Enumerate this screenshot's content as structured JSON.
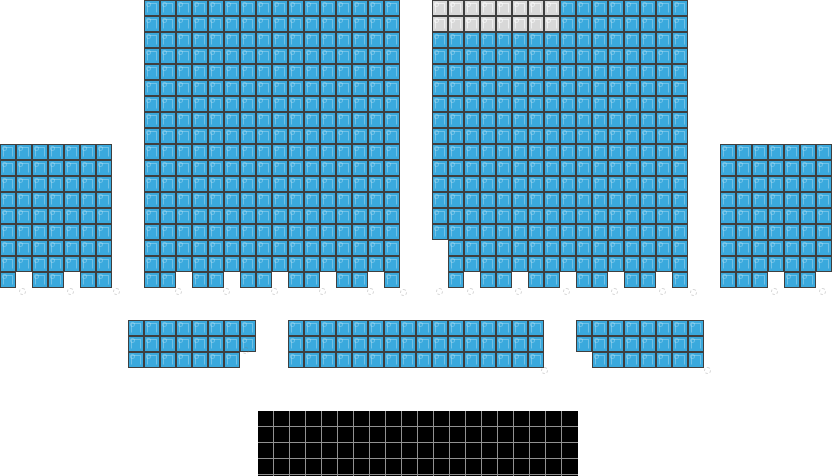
{
  "canvas": {
    "width": 832,
    "height": 476,
    "background": "#ffffff"
  },
  "seat": {
    "size": 16
  },
  "colors": {
    "seat_border": "#3f3f3f",
    "available_fill": "#3aa9dd",
    "available_glyph": "rgba(255,255,255,0.28)",
    "unavailable_fill": "#d8d8d8",
    "unavailable_glyph": "rgba(255,255,255,0.60)",
    "stage_fill": "#000000",
    "stage_line": "#919191",
    "ghost": "rgba(120,120,120,0.30)"
  },
  "sections": [
    {
      "id": "left-wing-section",
      "x": 0,
      "y": 144,
      "cols": 7,
      "rows": 9,
      "default": "available",
      "missing": [
        [
          9,
          2
        ],
        [
          9,
          5
        ]
      ],
      "overrides": []
    },
    {
      "id": "center-left-section",
      "x": 144,
      "y": 0,
      "cols": 16,
      "rows": 18,
      "default": "available",
      "missing": [
        [
          18,
          3
        ],
        [
          18,
          6
        ],
        [
          18,
          9
        ],
        [
          18,
          12
        ],
        [
          18,
          15
        ]
      ],
      "overrides": []
    },
    {
      "id": "center-right-section",
      "x": 432,
      "y": 0,
      "cols": 16,
      "rows": 18,
      "default": "available",
      "missing": [
        [
          16,
          1
        ],
        [
          17,
          1
        ],
        [
          18,
          1
        ],
        [
          18,
          3
        ],
        [
          18,
          6
        ],
        [
          18,
          9
        ],
        [
          18,
          12
        ],
        [
          18,
          15
        ]
      ],
      "overrides": [
        {
          "row_start": 1,
          "row_end": 2,
          "col_start": 1,
          "col_end": 8,
          "state": "unavailable"
        }
      ]
    },
    {
      "id": "right-wing-section",
      "x": 720,
      "y": 144,
      "cols": 7,
      "rows": 9,
      "default": "available",
      "missing": [
        [
          9,
          4
        ],
        [
          9,
          7
        ]
      ],
      "overrides": []
    },
    {
      "id": "mid-left-section",
      "x": 128,
      "y": 320,
      "cols": 8,
      "rows": 3,
      "default": "available",
      "missing": [
        [
          3,
          8
        ]
      ],
      "overrides": []
    },
    {
      "id": "mid-center-section",
      "x": 288,
      "y": 320,
      "cols": 16,
      "rows": 3,
      "default": "available",
      "missing": [],
      "overrides": []
    },
    {
      "id": "mid-right-section",
      "x": 576,
      "y": 320,
      "cols": 8,
      "rows": 3,
      "default": "available",
      "missing": [
        [
          3,
          1
        ]
      ],
      "overrides": []
    },
    {
      "id": "stage-block-section",
      "x": 258,
      "y": 411,
      "cols": 20,
      "rows": 5,
      "default": "stage",
      "missing": [],
      "overrides": []
    }
  ],
  "ghost_marks": [
    {
      "x": 19,
      "y": 288
    },
    {
      "x": 67,
      "y": 288
    },
    {
      "x": 113,
      "y": 288
    },
    {
      "x": 175,
      "y": 288
    },
    {
      "x": 223,
      "y": 288
    },
    {
      "x": 271,
      "y": 288
    },
    {
      "x": 319,
      "y": 288
    },
    {
      "x": 367,
      "y": 288
    },
    {
      "x": 400,
      "y": 289
    },
    {
      "x": 436,
      "y": 288
    },
    {
      "x": 467,
      "y": 288
    },
    {
      "x": 515,
      "y": 288
    },
    {
      "x": 563,
      "y": 288
    },
    {
      "x": 611,
      "y": 288
    },
    {
      "x": 659,
      "y": 288
    },
    {
      "x": 690,
      "y": 289
    },
    {
      "x": 771,
      "y": 288
    },
    {
      "x": 819,
      "y": 288
    },
    {
      "x": 242,
      "y": 347
    },
    {
      "x": 541,
      "y": 367
    },
    {
      "x": 704,
      "y": 367
    }
  ]
}
